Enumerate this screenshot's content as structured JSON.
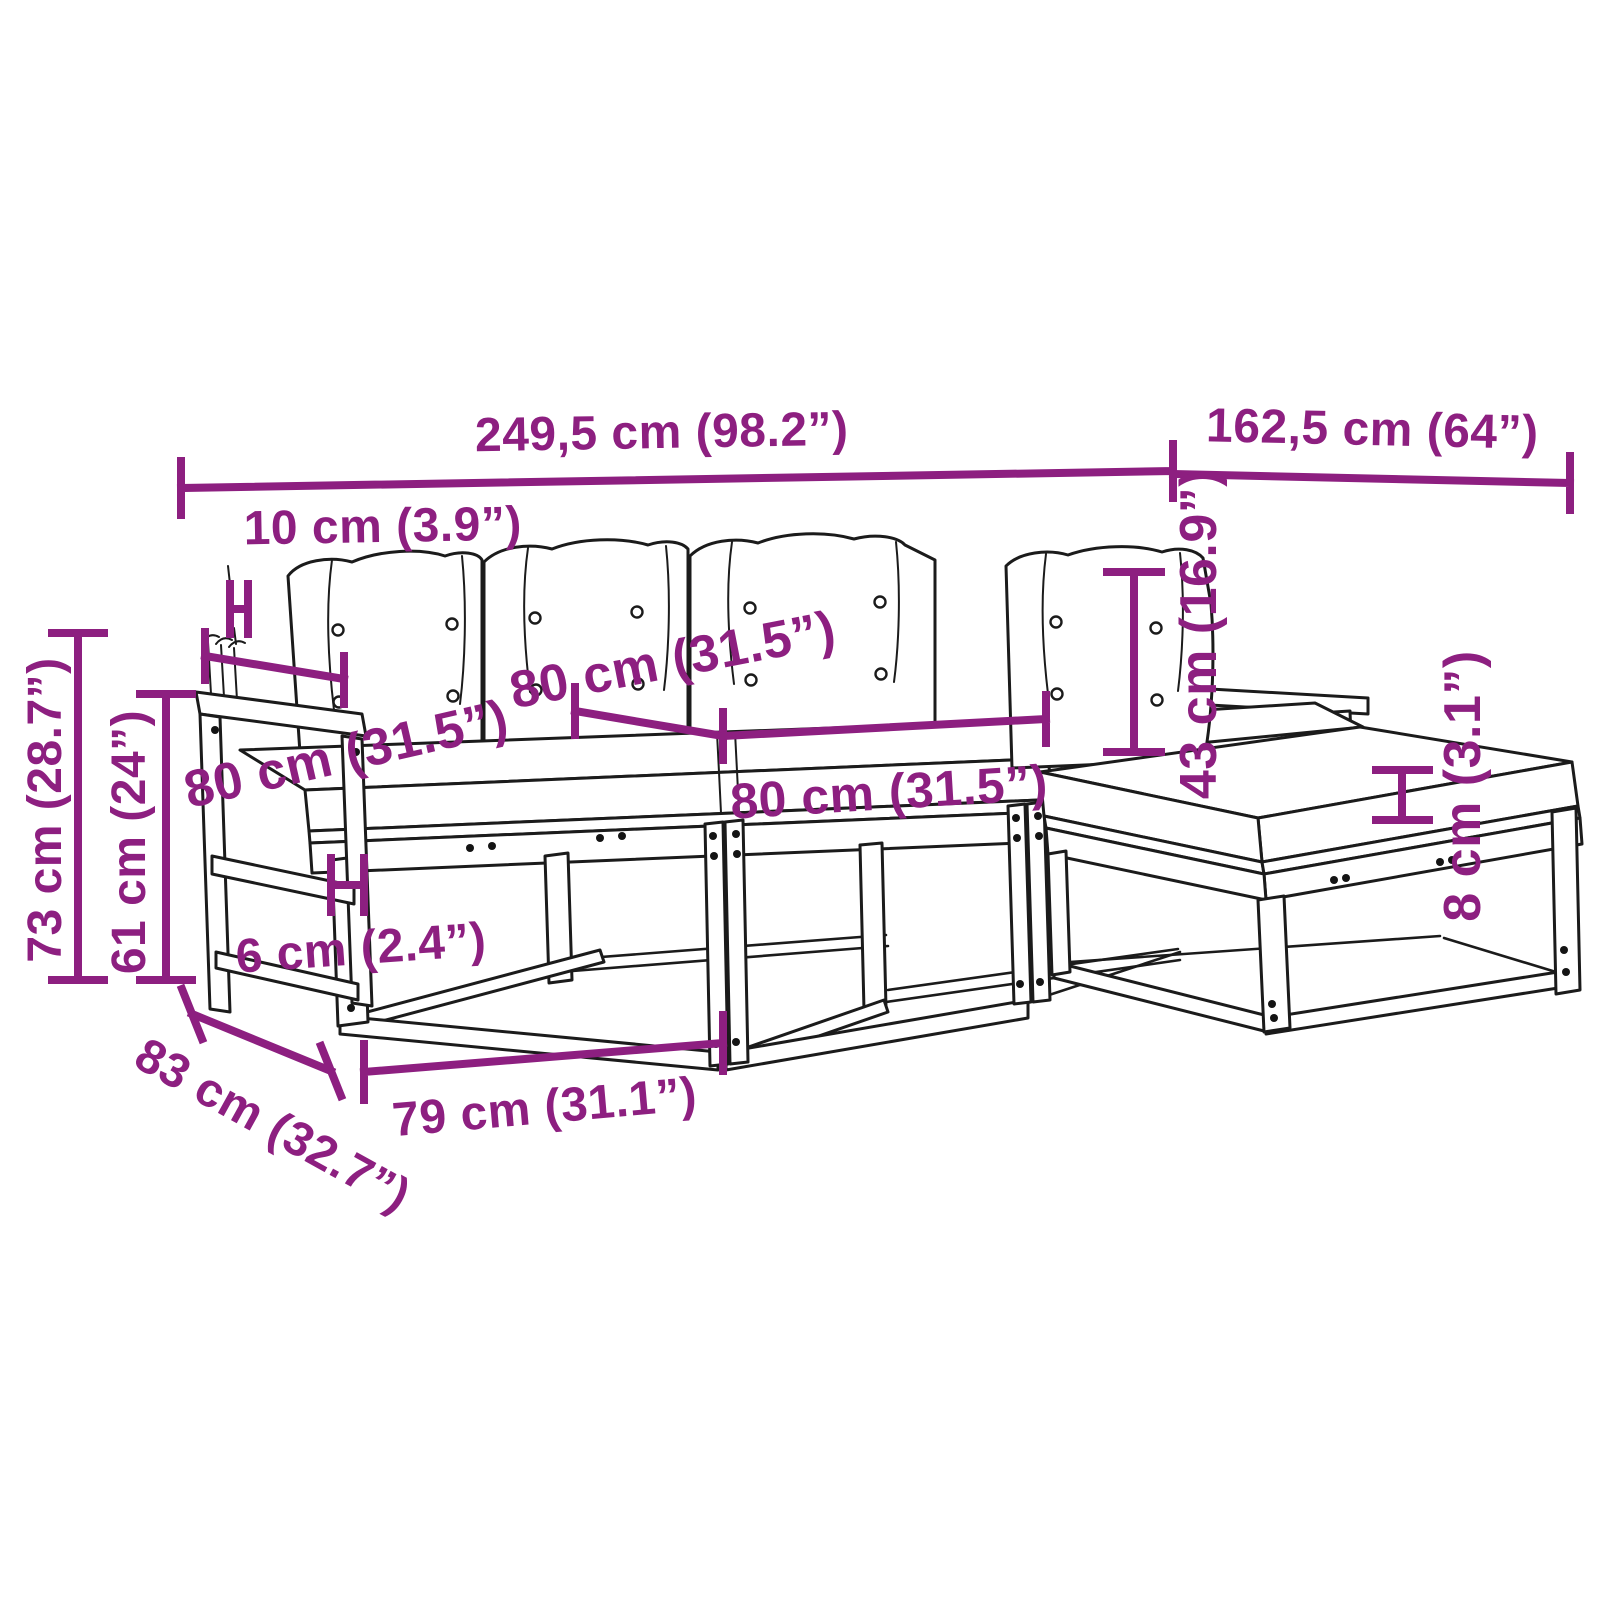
{
  "diagram": {
    "type": "product-dimension-diagram",
    "subject": "5-piece garden sofa set with cushions",
    "colors": {
      "dimension_annotation": "#8d1f80",
      "outline": "#1b1b1b",
      "background": "#ffffff"
    },
    "dims": {
      "overall_width": {
        "label": "249,5 cm (98.2”)"
      },
      "chaise_depth": {
        "label": "162,5 cm (64”)"
      },
      "back_offset": {
        "label": "10 cm (3.9”)"
      },
      "armrest_depth": {
        "label": "80 cm (31.5”)"
      },
      "back_cushion_width": {
        "label": "80 cm (31.5”)"
      },
      "seat_width": {
        "label": "80 cm (31.5”)"
      },
      "total_height": {
        "label": "73 cm (28.7”)"
      },
      "armrest_height": {
        "label": "61 cm (24”)"
      },
      "frame_thickness": {
        "label": "6 cm (2.4”)"
      },
      "side_depth": {
        "label": "83 cm (32.7”)"
      },
      "module_width": {
        "label": "79 cm (31.1”)"
      },
      "backrest_height": {
        "label": "43 cm (16.9”)"
      },
      "cushion_thickness": {
        "label": "8 cm (3.1”)"
      }
    }
  }
}
